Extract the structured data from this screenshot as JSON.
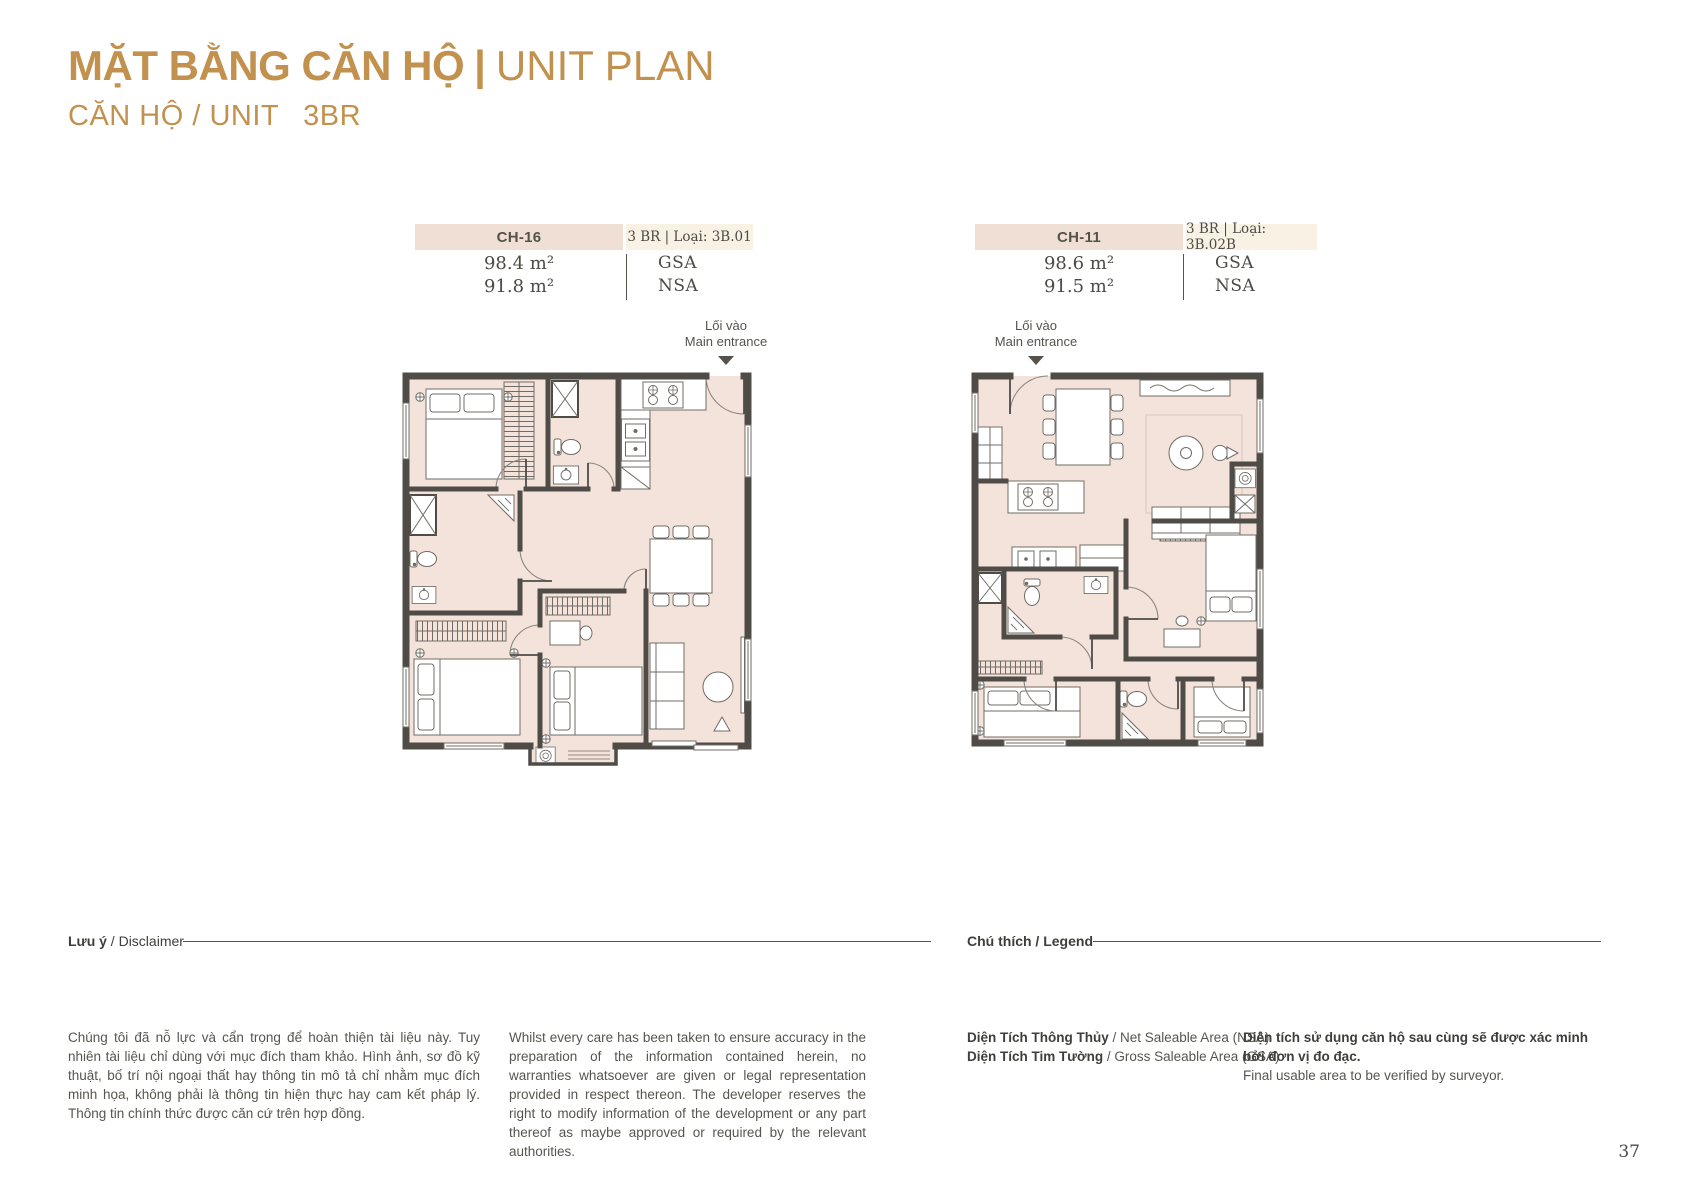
{
  "header": {
    "title_vi": "MẶT BẰNG CĂN HỘ",
    "separator": "|",
    "title_en": "UNIT PLAN",
    "subtitle_label": "CĂN HỘ / UNIT",
    "subtitle_value": "3BR"
  },
  "accent_colors": {
    "gold": "#c2914e",
    "box_beige": "#f0dfd5",
    "box_cream": "#f8f1e4",
    "floor_fill": "#f4e3da",
    "wall": "#4f4c48"
  },
  "units": [
    {
      "code": "CH-16",
      "type": "3 BR | Loại: 3B.01",
      "areas": [
        {
          "value": "98.4 m²",
          "label": "GSA"
        },
        {
          "value": "91.8 m²",
          "label": "NSA"
        }
      ],
      "entrance": {
        "line1": "Lối vào",
        "line2": "Main entrance"
      }
    },
    {
      "code": "CH-11",
      "type": "3 BR | Loại: 3B.02B",
      "areas": [
        {
          "value": "98.6 m²",
          "label": "GSA"
        },
        {
          "value": "91.5 m²",
          "label": "NSA"
        }
      ],
      "entrance": {
        "line1": "Lối vào",
        "line2": "Main entrance"
      }
    }
  ],
  "disclaimer": {
    "heading_bold": "Lưu ý",
    "heading_rest": " / Disclaimer",
    "text_vi": "Chúng tôi đã nỗ lực và cẩn trọng để hoàn thiện tài liệu này. Tuy nhiên tài liệu chỉ dùng với mục đích tham khảo. Hình ảnh, sơ đồ kỹ thuật, bố trí nội ngoại thất hay thông tin mô tả chỉ nhằm mục đích minh họa, không phải là thông tin hiện thực hay cam kết pháp lý. Thông tin chính thức được căn cứ trên hợp đồng.",
    "text_en": "Whilst every care has been taken to ensure accuracy in the preparation of the information contained herein, no warranties whatsoever are given or legal representation provided in respect thereon. The developer reserves the right to modify information of the development or any part thereof as maybe approved or required by the relevant authorities."
  },
  "legend": {
    "heading": "Chú thích / Legend",
    "items": [
      {
        "bold": "Diện Tích Thông Thủy",
        "rest": " / Net Saleable Area (NSA)"
      },
      {
        "bold": "Diện Tích Tim Tường",
        "rest": " / Gross Saleable Area (GSA)"
      }
    ],
    "note_bold": "Diện tích sử dụng căn hộ sau cùng sẽ được xác minh bởi đơn vị đo đạc.",
    "note_rest": "Final usable area to be verified by surveyor."
  },
  "page": {
    "number": "37"
  }
}
